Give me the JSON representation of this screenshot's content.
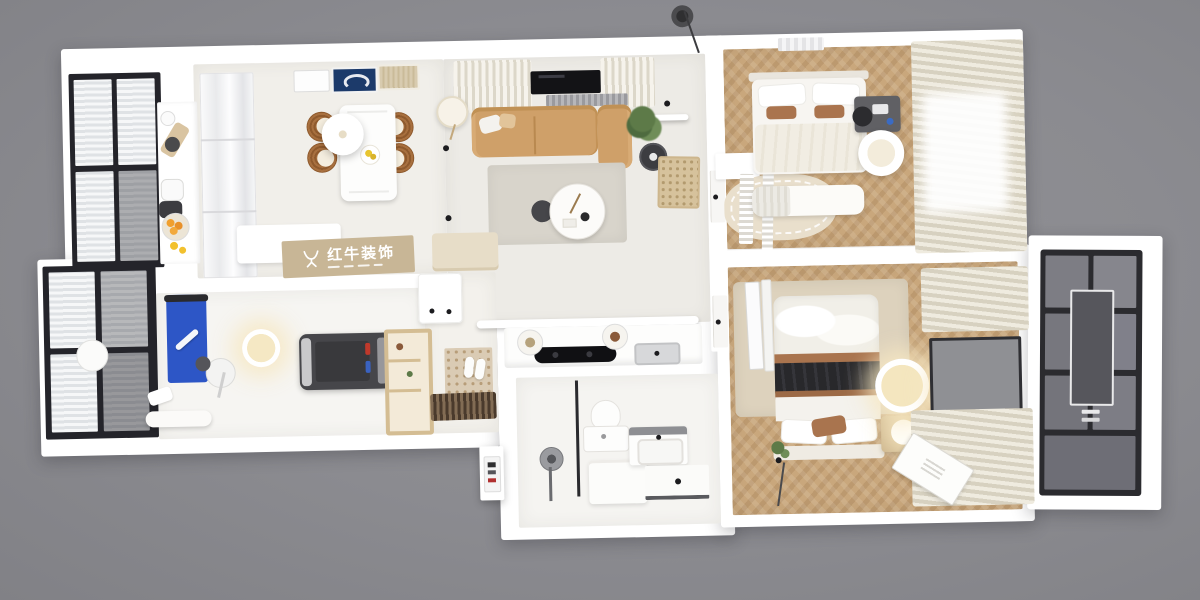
{
  "scene": {
    "description": "photorealistic 3D top-down render of a two-bedroom apartment floor plan on a gray backdrop",
    "background_color": "#8b8b90",
    "wall_color": "#ffffff"
  },
  "watermark": {
    "icon": "bull-logo-icon",
    "text": "红牛装饰",
    "band_color": "#c8b696"
  },
  "rooms": [
    {
      "id": "balcony-top-left",
      "label": "glazed balcony, black window frames"
    },
    {
      "id": "kitchen",
      "label": "kitchen run with tall gloss cabinets",
      "items": [
        "cutting-board",
        "black-canister",
        "kettle",
        "rice-cooker",
        "orange-fruit-bowl",
        "lemons"
      ]
    },
    {
      "id": "dining-area",
      "label": "dining area",
      "items": [
        "white-dining-table",
        "4-rattan-chairs",
        "round-pendant-lamp",
        "lemon-plate",
        "wall-art-navy",
        "wall-art-cane",
        "floor-lamp"
      ]
    },
    {
      "id": "living-room",
      "label": "living room",
      "items": [
        "tan-leather-sofa",
        "chaise",
        "window-with-curtains",
        "linear-light-bar",
        "gray-rug",
        "round-coffee-table",
        "dark-side-table",
        "potted-plant",
        "carved-screen-panel",
        "tv-console"
      ]
    },
    {
      "id": "hallway",
      "label": "hallway with two white doors"
    },
    {
      "id": "bedroom-guest",
      "label": "guest bedroom",
      "items": [
        "double-bed",
        "brown-lumbar-pillows",
        "desk-with-chair",
        "round-pouf",
        "foot-bench",
        "cream-rug",
        "striped-runners",
        "window-curtains"
      ]
    },
    {
      "id": "bedroom-master",
      "label": "master bedroom",
      "items": [
        "double-bed",
        "black-throw-blanket",
        "brown-accent-pillow",
        "nightstand-glow-lamp",
        "two-glowing-ceiling-lamps",
        "wall-tv-panel",
        "leaning-mirror",
        "beige-rug",
        "floor-canvas",
        "window-curtains",
        "plant-tuft"
      ]
    },
    {
      "id": "wardrobe-unit",
      "label": "dark smoked-glass wardrobe / sliding doors"
    },
    {
      "id": "gym-room",
      "label": "home gym",
      "items": [
        "blue-exercise-mat",
        "white-foam-roller",
        "treadmill",
        "red-and-blue-bottles",
        "spin-trainer",
        "glowing-ceiling-light",
        "wood-open-shelf",
        "white-bench",
        "towel"
      ]
    },
    {
      "id": "balcony-left",
      "label": "glazed balcony with round side table"
    },
    {
      "id": "kitchen-hob-counter",
      "label": "hob counter on bathroom partition",
      "items": [
        "black-induction-hob",
        "inset-sink",
        "two-counter-jars",
        "white-ledge"
      ]
    },
    {
      "id": "bathroom",
      "label": "bathroom",
      "items": [
        "shower-column",
        "dark-glass-screen",
        "toilet",
        "storage-block",
        "vanity-washbasin",
        "shower-tray-drain"
      ]
    },
    {
      "id": "entry",
      "label": "entry zone",
      "items": [
        "patterned-tile",
        "white-slippers",
        "dark-doormat",
        "door-sign-panel"
      ]
    },
    {
      "id": "exterior",
      "label": "outside details",
      "items": [
        "ceiling-light-puck",
        "hanging-cable"
      ]
    }
  ],
  "palette": {
    "background": "#8b8b90",
    "walls": "#ffffff",
    "light_floor": "#f0eeea",
    "wood_floor": "#c9a77c",
    "sofa_tan": "#cfa069",
    "rug_gray": "#d8d4cb",
    "mat_blue": "#2d56c6",
    "blanket_black": "#28282b",
    "pillow_brown": "#a9744e",
    "frame_black": "#24242a",
    "curtain_cream": "#eae5d8",
    "lamp_glow": "#f5e8c4",
    "watermark_tan": "#c8b696",
    "orange_fruit": "#f09f2e"
  }
}
